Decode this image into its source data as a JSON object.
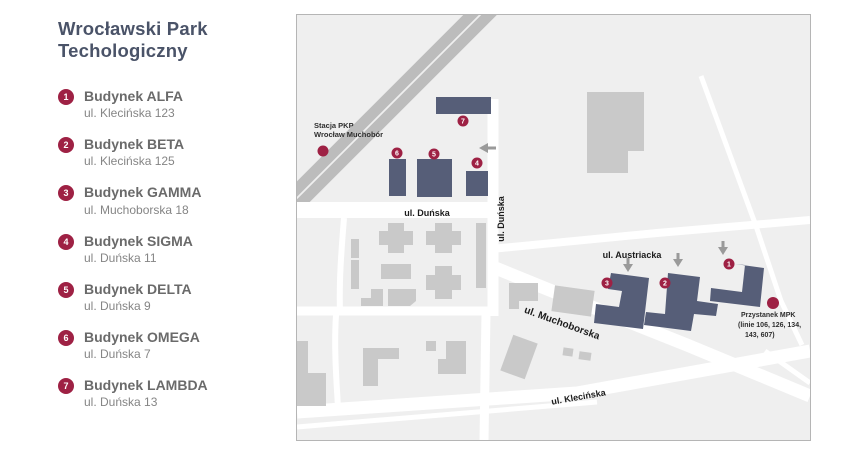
{
  "title": {
    "line1": "Wrocławski Park",
    "line2": "Techologiczny"
  },
  "legend": [
    {
      "num": "1",
      "name": "Budynek ALFA",
      "address": "ul. Klecińska 123"
    },
    {
      "num": "2",
      "name": "Budynek BETA",
      "address": "ul. Klecińska 125"
    },
    {
      "num": "3",
      "name": "Budynek GAMMA",
      "address": "ul. Muchoborska 18"
    },
    {
      "num": "4",
      "name": "Budynek SIGMA",
      "address": "ul. Duńska 11"
    },
    {
      "num": "5",
      "name": "Budynek DELTA",
      "address": "ul. Duńska 9"
    },
    {
      "num": "6",
      "name": "Budynek OMEGA",
      "address": "ul. Duńska 7"
    },
    {
      "num": "7",
      "name": "Budynek LAMBDA",
      "address": "ul. Duńska 13"
    }
  ],
  "map": {
    "streets": {
      "dunska_h": "ul. Duńska",
      "dunska_v": "ul. Duńska",
      "austriacka": "ul. Austriacka",
      "muchoborska": "ul. Muchoborska",
      "klecinska": "ul. Klecińska"
    },
    "station": {
      "line1": "Stacja PKP",
      "line2": "Wrocław Muchobór"
    },
    "bus_stop": {
      "line1": "Przystanek MPK",
      "line2": "(linie 106, 126, 134,",
      "line3": "143, 607)"
    },
    "marker_numbers": {
      "m1": "1",
      "m2": "2",
      "m3": "3",
      "m4": "4",
      "m5": "5",
      "m6": "6",
      "m7": "7"
    },
    "colors": {
      "building_navy": "#565e78",
      "marker_red": "#9e2144",
      "building_gray": "#c9c9c9",
      "rail_gray": "#bcbcbc",
      "road_white": "#ffffff",
      "map_bg": "#efefef",
      "title_color": "#4a5368"
    }
  }
}
